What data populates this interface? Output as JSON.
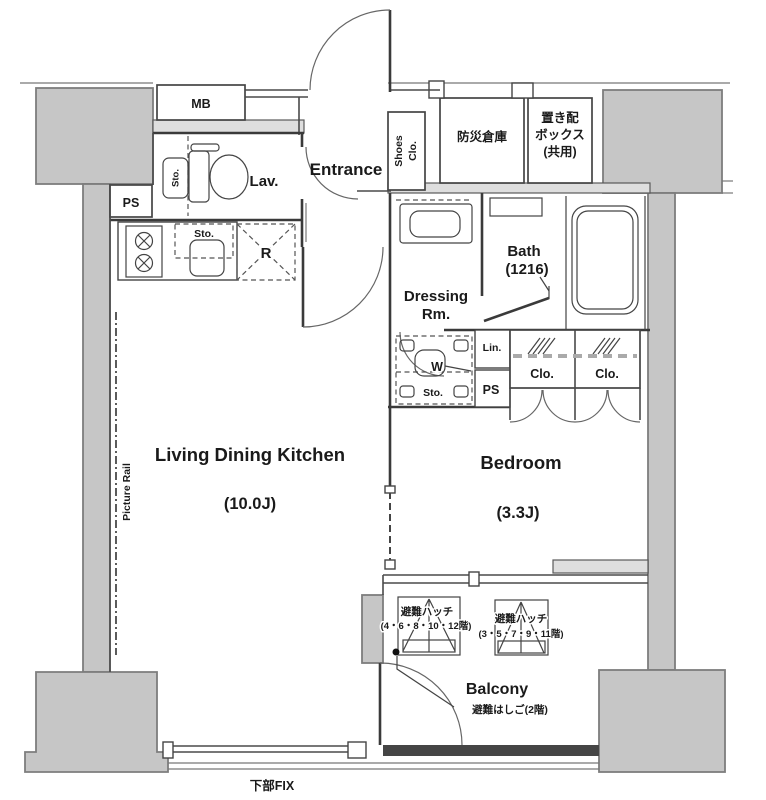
{
  "plan": {
    "type": "apartment-floor-plan",
    "colors": {
      "background": "#ffffff",
      "structure_fill": "#c6c6c6",
      "wall_line": "#3a3a3a",
      "text": "#1a1a1a"
    },
    "rooms": [
      {
        "name": "Living Dining Kitchen",
        "size": "(10.0J)"
      },
      {
        "name": "Bedroom",
        "size": "(3.3J)"
      },
      {
        "name": "Bath",
        "size": "(1216)"
      },
      {
        "name": "Dressing Rm."
      },
      {
        "name": "Lav."
      },
      {
        "name": "Entrance"
      },
      {
        "name": "Balcony"
      }
    ]
  },
  "labels": {
    "mb": "MB",
    "ps_upper": "PS",
    "lav": "Lav.",
    "lav_sto": "Sto.",
    "entrance": "Entrance",
    "shoes_line1": "Shoes",
    "shoes_line2": "Clo.",
    "disaster_storage": "防災倉庫",
    "delivery_box_line1": "置き配",
    "delivery_box_line2": "ボックス",
    "delivery_box_line3": "(共用)",
    "kitchen_sto": "Sto.",
    "refrigerator": "R",
    "dressing_line1": "Dressing",
    "dressing_line2": "Rm.",
    "bath_line1": "Bath",
    "bath_line2": "(1216)",
    "washer": "W",
    "linen": "Lin.",
    "ps_lower": "PS",
    "washer_sto": "Sto.",
    "closet1": "Clo.",
    "closet2": "Clo.",
    "ldk_line1": "Living Dining Kitchen",
    "ldk_line2": "(10.0J)",
    "bedroom_line1": "Bedroom",
    "bedroom_line2": "(3.3J)",
    "picture_rail": "Picture Rail",
    "hatch1_line1": "避難ハッチ",
    "hatch1_line2": "(4・6・8・10・12階)",
    "hatch2_line1": "避難ハッチ",
    "hatch2_line2": "(3・5・7・9・11階)",
    "balcony": "Balcony",
    "escape_ladder": "避難はしご(2階)",
    "bottom_fix": "下部FIX"
  }
}
